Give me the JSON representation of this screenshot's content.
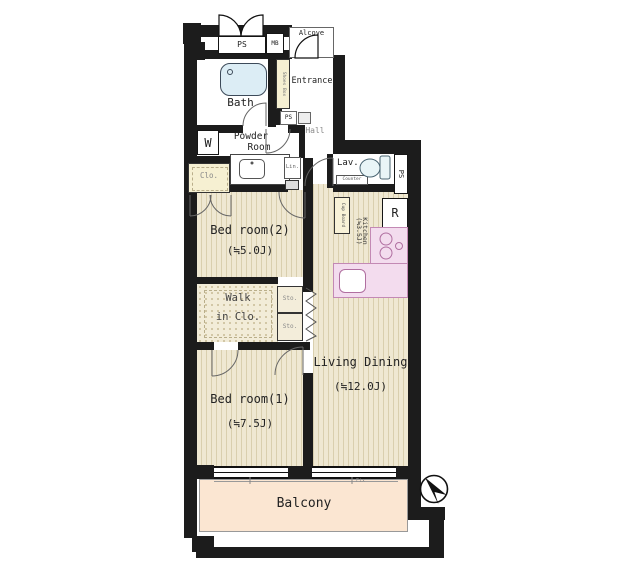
{
  "colors": {
    "wall": "#1c1c1c",
    "floor_beige": "#efe8d2",
    "floor_stripe": "#d9cfae",
    "balcony_peach": "#fbe6d2",
    "counter_pink": "#f3dcee",
    "fixture_blue": "#dcedf5",
    "cabinet_beige": "#f6f0d2"
  },
  "labels": {
    "ps_top": "PS",
    "mb": "MB",
    "alcove": "Alcove",
    "bath": "Bath",
    "entrance": "Entrance",
    "shoes_box": "Shoes Box",
    "ps_entrance": "PS",
    "hall": "Hall",
    "washer": "W",
    "powder_room_line1": "Powder",
    "powder_room_line2": "Room",
    "linen": "Lin.",
    "closet": "Clo.",
    "lavatory": "Lav.",
    "counter": "Counter",
    "ps_side": "PS",
    "refrigerator": "R",
    "cup_board": "Cup Board",
    "kitchen_name": "Kitchen",
    "kitchen_size": "(≒3.5J)",
    "bedroom2_name": "Bed room(2)",
    "bedroom2_size": "(≒5.0J)",
    "walkin_line1": "Walk",
    "walkin_line2": "in Clo.",
    "storage": "Sto.",
    "bedroom1_name": "Bed room(1)",
    "bedroom1_size": "(≒7.5J)",
    "living_name": "Living Dining",
    "living_size": "(≒12.0J)",
    "balcony": "Balcony",
    "fix": "Fix"
  }
}
